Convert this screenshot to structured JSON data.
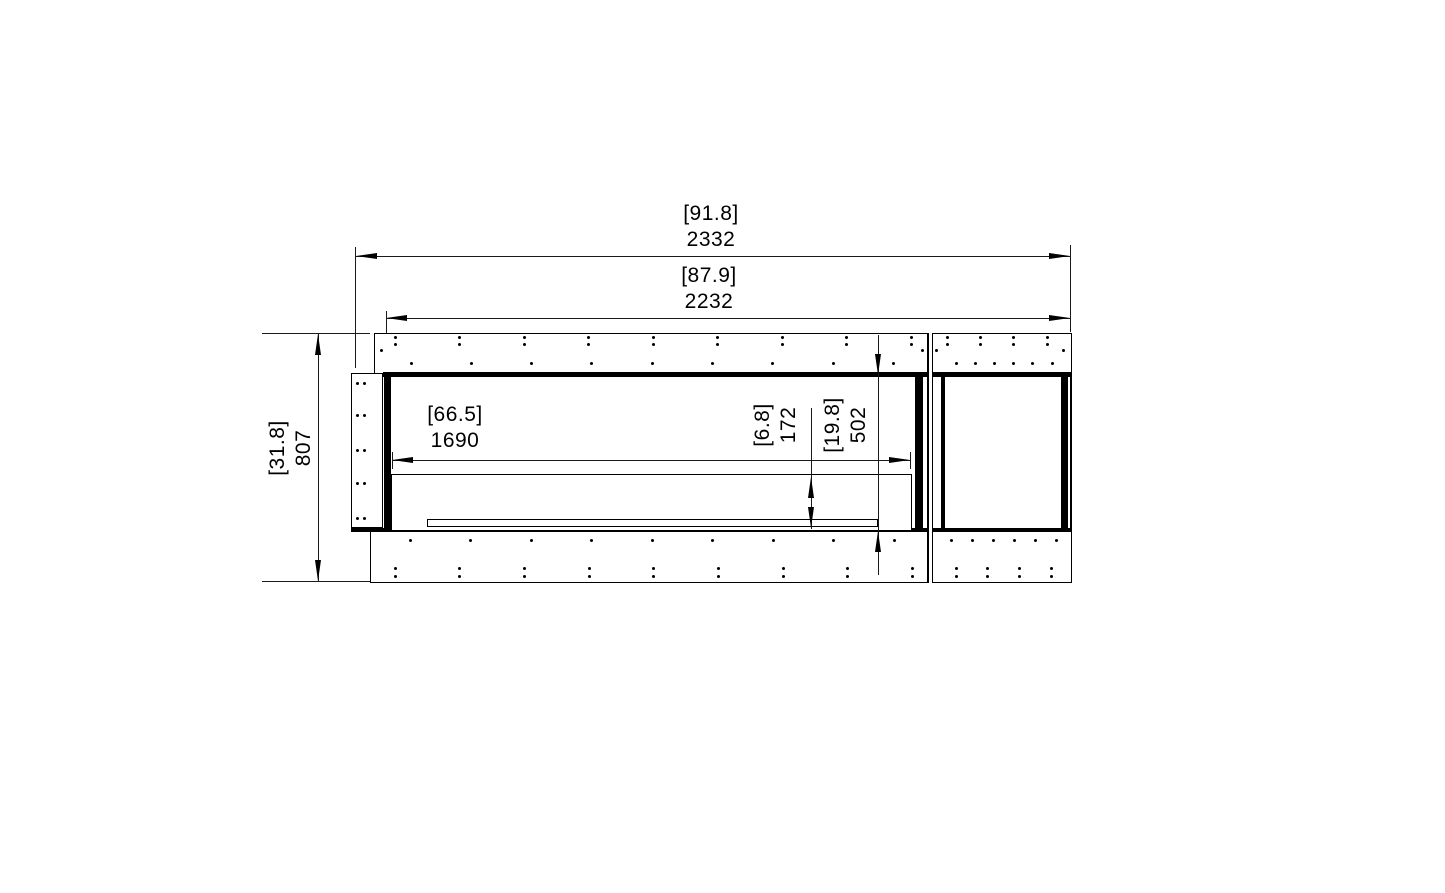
{
  "drawing": {
    "type": "fireplace-firebox-dimension-drawing",
    "units": {
      "primary": "mm",
      "bracketed": "in"
    },
    "colors": {
      "line": "#000000",
      "background": "#ffffff"
    },
    "dims": {
      "overall_width": {
        "imperial": "[91.8]",
        "metric": "2332"
      },
      "inner_width": {
        "imperial": "[87.9]",
        "metric": "2232"
      },
      "overall_height": {
        "imperial": "[31.8]",
        "metric": "807"
      },
      "burner_width": {
        "imperial": "[66.5]",
        "metric": "1690"
      },
      "tray_height": {
        "imperial": "[6.8]",
        "metric": "172"
      },
      "opening_height": {
        "imperial": "[19.8]",
        "metric": "502"
      }
    }
  }
}
